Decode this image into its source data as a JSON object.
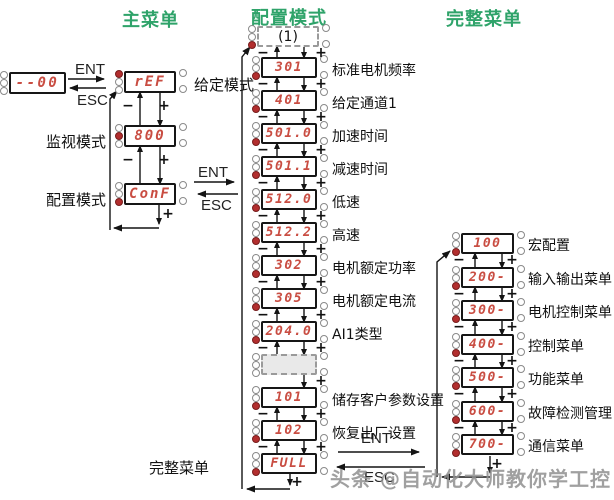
{
  "titles": {
    "main_menu": "主菜单",
    "config_mode": "配置模式",
    "full_menu": "完整菜单"
  },
  "keys": {
    "ent": "ENT",
    "esc": "ESC",
    "minus": "−",
    "plus": "+"
  },
  "main_column": {
    "initial_value": "--00",
    "modes": [
      {
        "value": "rEF",
        "label": "给定模式",
        "led": "top"
      },
      {
        "value": "800",
        "label": "监视模式",
        "led": "middle"
      },
      {
        "value": "ConF",
        "label": "配置模式",
        "led": "bottom"
      }
    ]
  },
  "config_column": {
    "entry_box": "(1)",
    "items": [
      {
        "value": "301",
        "label": "标准电机频率"
      },
      {
        "value": "401",
        "label": "给定通道1"
      },
      {
        "value": "501.0",
        "label": "加速时间"
      },
      {
        "value": "501.1",
        "label": "减速时间"
      },
      {
        "value": "512.0",
        "label": "低速"
      },
      {
        "value": "512.2",
        "label": "高速"
      },
      {
        "value": "302",
        "label": "电机额定功率"
      },
      {
        "value": "305",
        "label": "电机额定电流"
      },
      {
        "value": "204.0",
        "label": "AI1类型"
      },
      {
        "value": "",
        "label": "",
        "dotted": true
      },
      {
        "value": "101",
        "label": "储存客户参数设置"
      },
      {
        "value": "102",
        "label": "恢复出厂设置"
      },
      {
        "value": "FULL",
        "label": ""
      }
    ],
    "exit_label": "完整菜单"
  },
  "full_column": {
    "items": [
      {
        "value": "100",
        "label": "宏配置"
      },
      {
        "value": "200-",
        "label": "输入输出菜单"
      },
      {
        "value": "300-",
        "label": "电机控制菜单"
      },
      {
        "value": "400-",
        "label": "控制菜单"
      },
      {
        "value": "500-",
        "label": "功能菜单"
      },
      {
        "value": "600-",
        "label": "故障检测管理"
      },
      {
        "value": "700-",
        "label": "通信菜单"
      }
    ]
  },
  "watermark": "头条 @自动化大师教你学工控"
}
